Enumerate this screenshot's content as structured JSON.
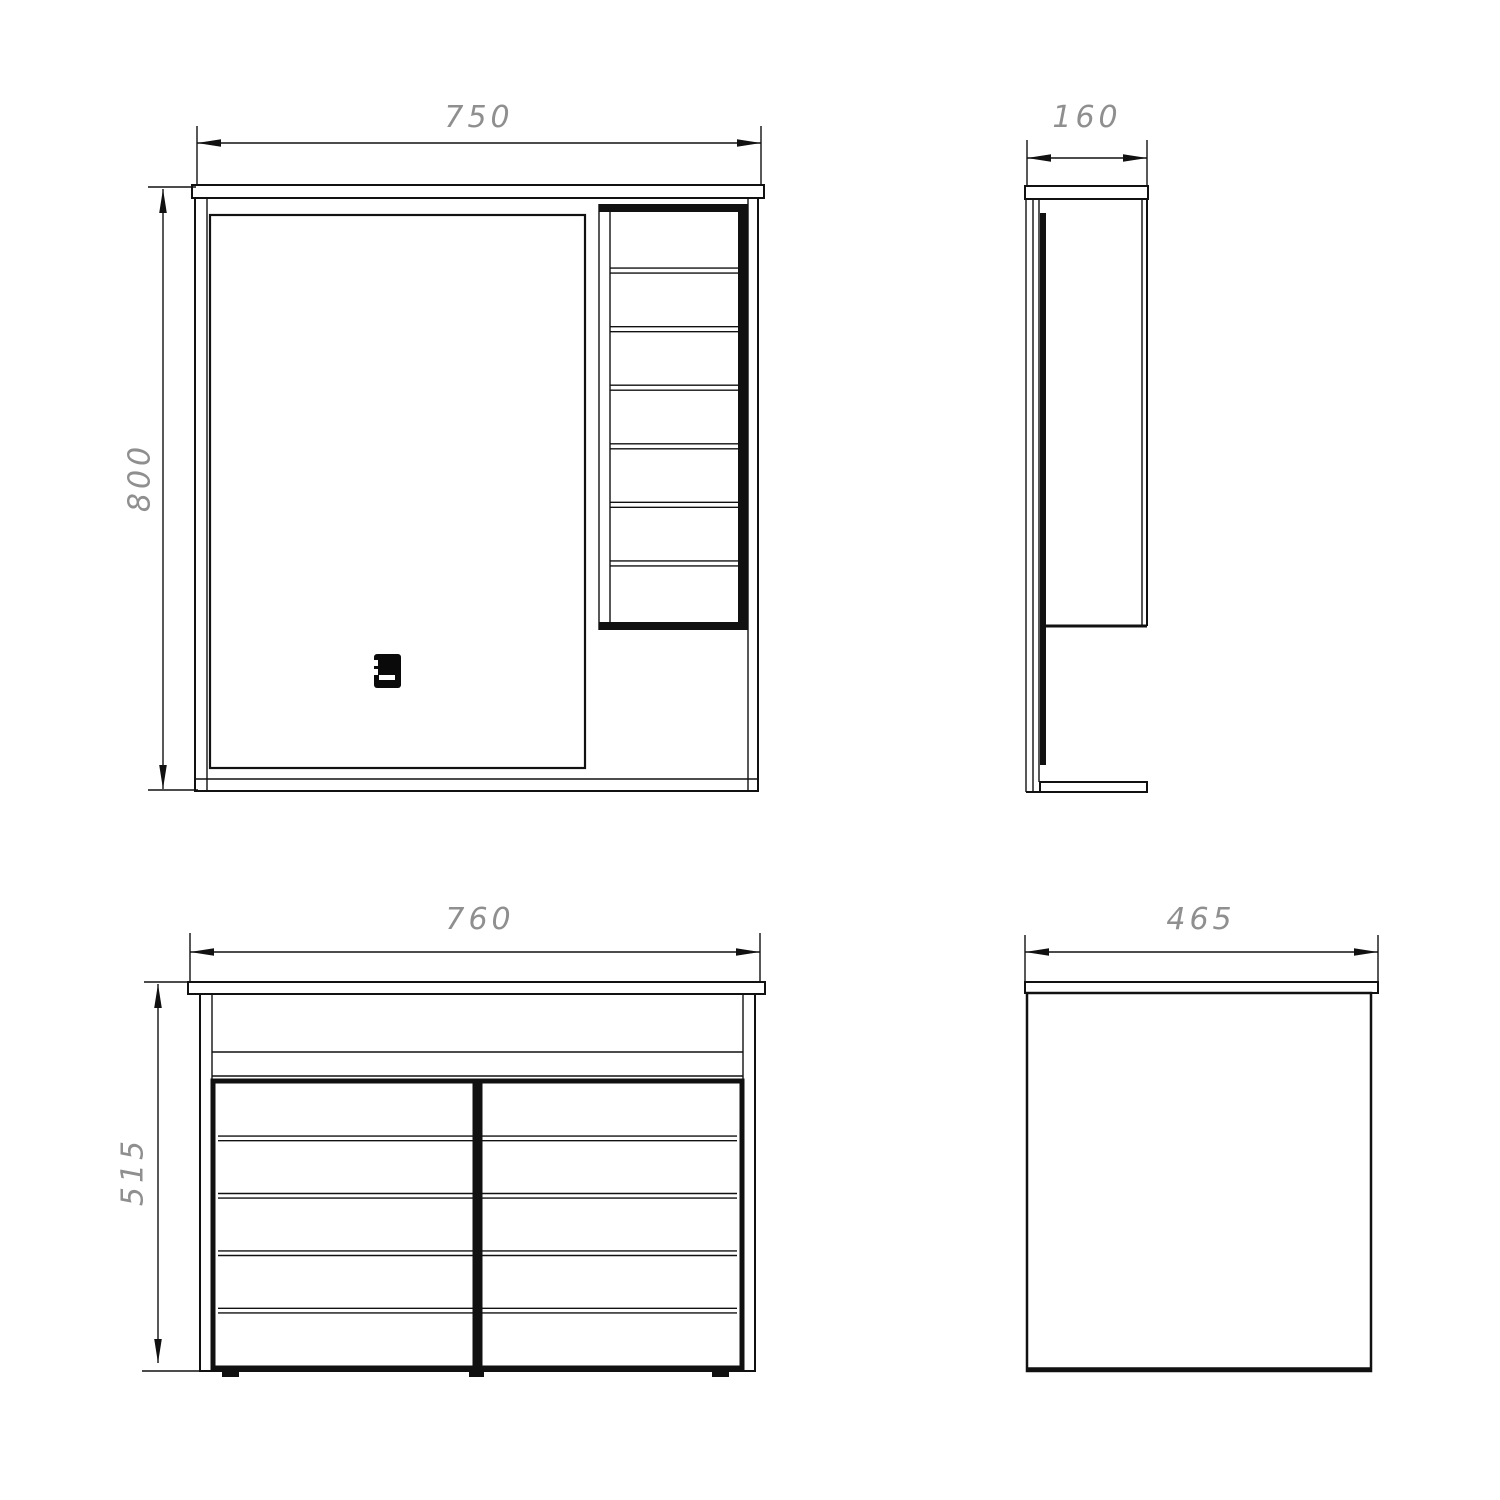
{
  "drawing": {
    "background_color": "#ffffff",
    "line_color": "#111111",
    "dim_text_color": "#8f8f8f",
    "views": {
      "mirror_cabinet_front": {
        "width_label": "750",
        "height_label": "800",
        "shelf_count": 7,
        "icon": "touch-switch-icon"
      },
      "mirror_cabinet_side": {
        "depth_label": "160"
      },
      "vanity_front": {
        "width_label": "760",
        "height_label": "515",
        "drawer_rows": 5,
        "drawer_columns": 2
      },
      "vanity_side": {
        "depth_label": "465"
      }
    }
  }
}
